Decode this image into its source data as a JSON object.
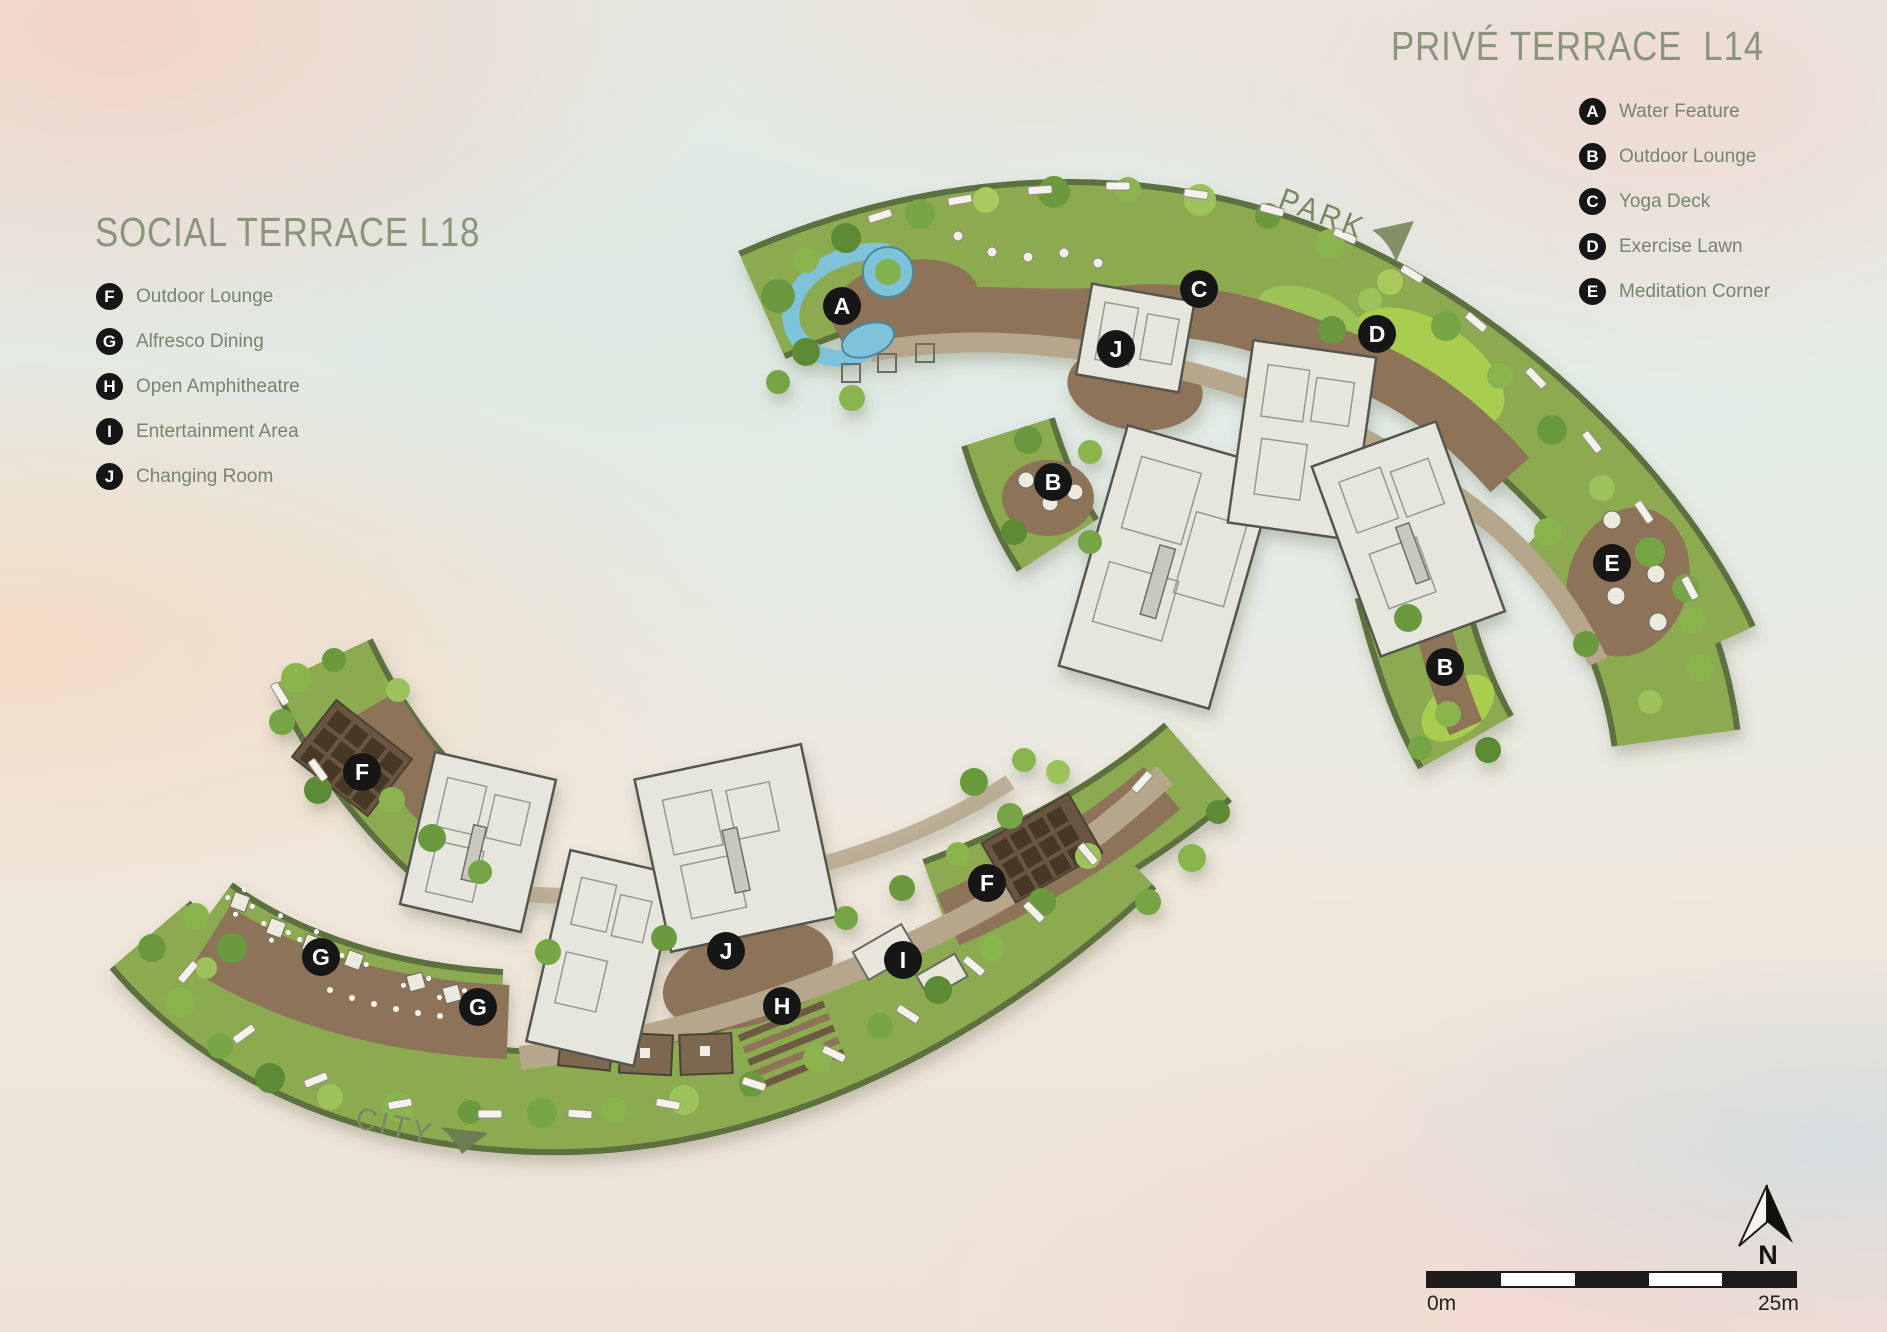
{
  "titles": {
    "prive": "PRIVÉ TERRACE  L14",
    "social": "SOCIAL TERRACE L18"
  },
  "legend_prive": {
    "items": [
      {
        "key": "A",
        "label": "Water Feature"
      },
      {
        "key": "B",
        "label": "Outdoor Lounge"
      },
      {
        "key": "C",
        "label": "Yoga Deck"
      },
      {
        "key": "D",
        "label": "Exercise Lawn"
      },
      {
        "key": "E",
        "label": "Meditation Corner"
      }
    ]
  },
  "legend_social": {
    "items": [
      {
        "key": "F",
        "label": "Outdoor Lounge"
      },
      {
        "key": "G",
        "label": "Alfresco Dining"
      },
      {
        "key": "H",
        "label": "Open Amphitheatre"
      },
      {
        "key": "I",
        "label": "Entertainment Area"
      },
      {
        "key": "J",
        "label": "Changing Room"
      }
    ]
  },
  "direction_labels": {
    "park": "PARK",
    "city": "CITY"
  },
  "compass": {
    "north": "N"
  },
  "scale_bar": {
    "start": "0m",
    "end": "25m"
  },
  "plan_markers": {
    "prive": [
      {
        "letter": "A",
        "x": 842,
        "y": 306
      },
      {
        "letter": "J",
        "x": 1116,
        "y": 349
      },
      {
        "letter": "C",
        "x": 1199,
        "y": 289
      },
      {
        "letter": "D",
        "x": 1377,
        "y": 334
      },
      {
        "letter": "B",
        "x": 1053,
        "y": 482
      },
      {
        "letter": "E",
        "x": 1612,
        "y": 563
      },
      {
        "letter": "B",
        "x": 1445,
        "y": 667
      }
    ],
    "social": [
      {
        "letter": "F",
        "x": 362,
        "y": 772
      },
      {
        "letter": "G",
        "x": 321,
        "y": 957
      },
      {
        "letter": "G",
        "x": 478,
        "y": 1007
      },
      {
        "letter": "J",
        "x": 726,
        "y": 951
      },
      {
        "letter": "H",
        "x": 782,
        "y": 1006
      },
      {
        "letter": "I",
        "x": 903,
        "y": 960
      },
      {
        "letter": "F",
        "x": 987,
        "y": 883
      }
    ]
  },
  "colors": {
    "title": "#8b957b",
    "legend_text": "#76856d",
    "direction_label": "#7a8763",
    "marker_bg": "#161616",
    "marker_text": "#ffffff",
    "scale_bar": "#1c1c1c"
  }
}
